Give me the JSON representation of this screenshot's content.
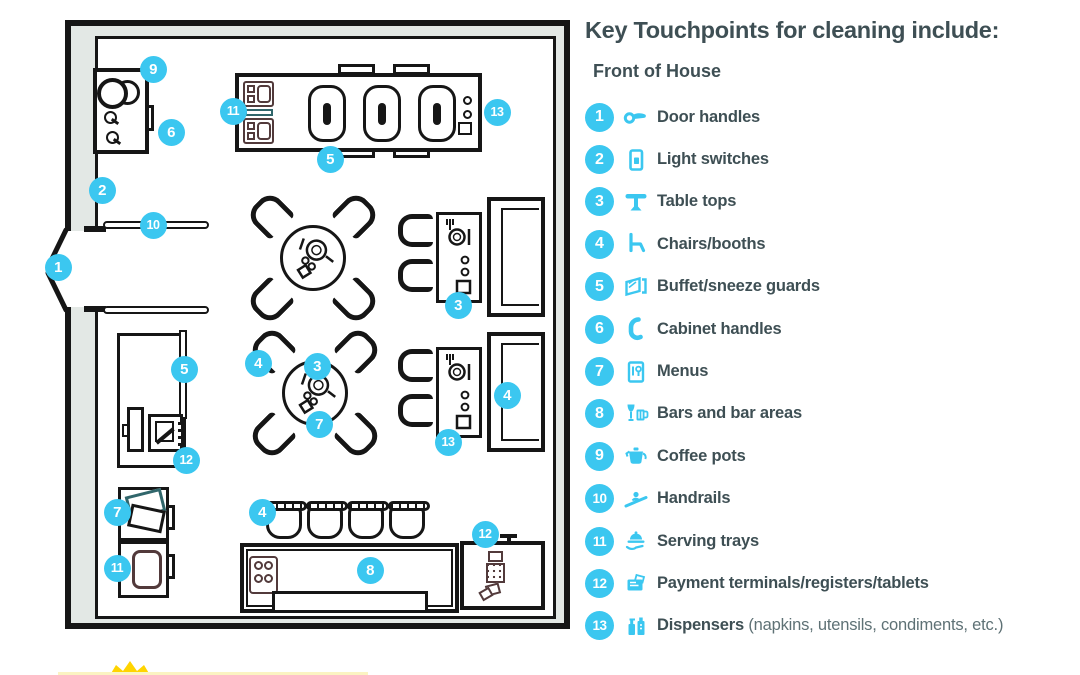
{
  "legend": {
    "title": "Key Touchpoints for cleaning include:",
    "subtitle": "Front of House",
    "items": [
      {
        "num": "1",
        "label": "Door handles",
        "icon": "door-handle-icon"
      },
      {
        "num": "2",
        "label": "Light switches",
        "icon": "light-switch-icon"
      },
      {
        "num": "3",
        "label": "Table tops",
        "icon": "table-icon"
      },
      {
        "num": "4",
        "label": "Chairs/booths",
        "icon": "chair-icon"
      },
      {
        "num": "5",
        "label": "Buffet/sneeze guards",
        "icon": "sneeze-guard-icon"
      },
      {
        "num": "6",
        "label": "Cabinet handles",
        "icon": "cabinet-handle-icon"
      },
      {
        "num": "7",
        "label": "Menus",
        "icon": "menu-icon"
      },
      {
        "num": "8",
        "label": "Bars and bar areas",
        "icon": "bar-icon"
      },
      {
        "num": "9",
        "label": "Coffee pots",
        "icon": "coffee-pot-icon"
      },
      {
        "num": "10",
        "label": "Handrails",
        "icon": "handrail-icon"
      },
      {
        "num": "11",
        "label": "Serving trays",
        "icon": "serving-tray-icon"
      },
      {
        "num": "12",
        "label": "Payment terminals/registers/tablets",
        "icon": "payment-terminal-icon"
      },
      {
        "num": "13",
        "label": "Dispensers",
        "suffix": " (napkins, utensils, condiments, etc.)",
        "icon": "dispenser-icon"
      }
    ]
  },
  "floor_plan": {
    "markers": [
      {
        "n": "1",
        "x": 58,
        "y": 267
      },
      {
        "n": "2",
        "x": 102,
        "y": 190
      },
      {
        "n": "9",
        "x": 153,
        "y": 69
      },
      {
        "n": "6",
        "x": 171,
        "y": 132
      },
      {
        "n": "10",
        "x": 153,
        "y": 225
      },
      {
        "n": "11",
        "x": 233,
        "y": 111
      },
      {
        "n": "5",
        "x": 330,
        "y": 159
      },
      {
        "n": "13",
        "x": 497,
        "y": 112
      },
      {
        "n": "3",
        "x": 458,
        "y": 305
      },
      {
        "n": "4",
        "x": 258,
        "y": 363
      },
      {
        "n": "3",
        "x": 317,
        "y": 366
      },
      {
        "n": "7",
        "x": 319,
        "y": 424
      },
      {
        "n": "4",
        "x": 507,
        "y": 395
      },
      {
        "n": "13",
        "x": 448,
        "y": 442
      },
      {
        "n": "5",
        "x": 184,
        "y": 369
      },
      {
        "n": "12",
        "x": 186,
        "y": 460
      },
      {
        "n": "7",
        "x": 117,
        "y": 512
      },
      {
        "n": "11",
        "x": 117,
        "y": 568
      },
      {
        "n": "4",
        "x": 262,
        "y": 512
      },
      {
        "n": "8",
        "x": 370,
        "y": 570
      },
      {
        "n": "12",
        "x": 485,
        "y": 534
      }
    ]
  },
  "colors": {
    "accent_cyan": "#3BC7F0",
    "text_dark": "#3E4F54",
    "line_black": "#161616",
    "wall_gray": "#E3E8E5",
    "detail_maroon": "#523A3B",
    "detail_teal": "#30666B",
    "logo_yellow": "#FFD400"
  }
}
